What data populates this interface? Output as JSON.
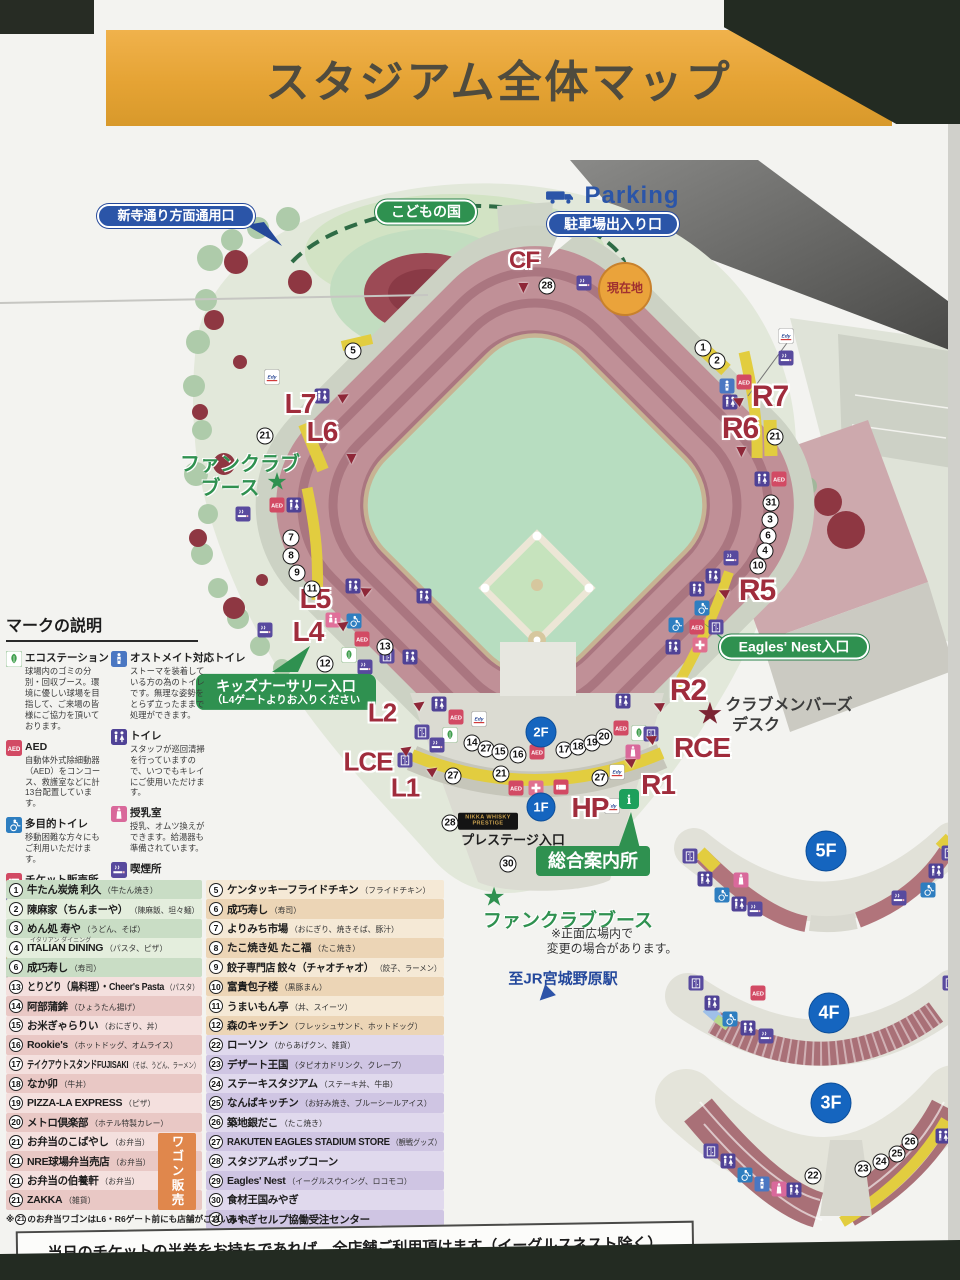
{
  "banner": {
    "title": "スタジアム全体マップ"
  },
  "bottom_note": "当日のチケットの半券をお持ちであれば、全店舗ご利用頂けます（イーグルスネスト除く）",
  "map": {
    "pills": [
      {
        "name": "shintera-gate-pill",
        "cls": "bluepill",
        "text": "新寺通り方面通用口",
        "x": 176,
        "y": 216,
        "w": 158,
        "fs": 13
      },
      {
        "name": "kodomonokuni-pill",
        "cls": "greenpill",
        "text": "こどもの国",
        "x": 426,
        "y": 212,
        "w": 102,
        "fs": 14
      },
      {
        "name": "parking-gate-pill",
        "cls": "bluepill",
        "text": "駐車場出入り口",
        "x": 613,
        "y": 224,
        "w": 132,
        "fs": 14
      },
      {
        "name": "kids-nursery-entrance-pill",
        "cls": "greenbox kidsbox",
        "lines": [
          "キッズナーサリー入口",
          "（L4ゲートよりお入りください"
        ],
        "x": 286,
        "y": 692,
        "w": 180
      },
      {
        "name": "eagles-nest-entrance-pill",
        "cls": "greenpill",
        "text": "Eagles' Nest入口",
        "x": 794,
        "y": 647,
        "w": 150,
        "fs": 14
      },
      {
        "name": "information-center-box",
        "cls": "greenbox sougou",
        "text": "総合案内所",
        "x": 593,
        "y": 861,
        "w": 114,
        "fs": 18
      },
      {
        "name": "current-location-badge",
        "cls": "genchi",
        "text": "現在地",
        "x": 625,
        "y": 289
      },
      {
        "name": "nikka-whisky-prestige-sign",
        "cls": "nikka",
        "lines": [
          "NIKKA WHISKY",
          "PRESTIGE"
        ],
        "x": 488,
        "y": 821,
        "w": 60
      }
    ],
    "texts": [
      {
        "name": "parking-label",
        "t": "Parking",
        "x": 632,
        "y": 196,
        "cls": "parking",
        "fs": 24
      },
      {
        "name": "fanclub-booth-left-line1",
        "t": "ファンクラブ",
        "x": 240,
        "y": 462,
        "cls": "gtext",
        "fs": 20
      },
      {
        "name": "fanclub-booth-left-line2",
        "t": "ブース",
        "x": 230,
        "y": 486,
        "cls": "gtext",
        "fs": 20
      },
      {
        "name": "fanclub-star-left",
        "t": "★",
        "x": 277,
        "y": 482,
        "cls": "star-green",
        "fs": 24
      },
      {
        "name": "fanclub-booth-front",
        "t": "ファンクラブブース",
        "x": 568,
        "y": 919,
        "cls": "gtext",
        "fs": 19
      },
      {
        "name": "fanclub-star-front",
        "t": "★",
        "x": 494,
        "y": 897,
        "cls": "star-green",
        "fs": 26
      },
      {
        "name": "front-plaza-note-line1",
        "t": "※正面広場内で",
        "x": 592,
        "y": 933,
        "cls": "note",
        "fs": 12
      },
      {
        "name": "front-plaza-note-line2",
        "t": "変更の場合があります。",
        "x": 612,
        "y": 948,
        "cls": "note",
        "fs": 12
      },
      {
        "name": "jr-station-label",
        "t": "至JR宮城野原駅",
        "x": 563,
        "y": 978,
        "cls": "jrtext",
        "fs": 15
      },
      {
        "name": "jr-station-arrow",
        "t": "▶",
        "x": 546,
        "y": 996,
        "cls": "jrarrow",
        "fs": 20,
        "rot": 135
      },
      {
        "name": "club-members-desk-line1",
        "t": "クラブメンバーズ",
        "x": 789,
        "y": 703,
        "cls": "dtext",
        "fs": 16
      },
      {
        "name": "club-members-desk-line2",
        "t": "デスク",
        "x": 756,
        "y": 723,
        "cls": "dtext",
        "fs": 16
      },
      {
        "name": "club-members-star",
        "t": "★",
        "x": 710,
        "y": 714,
        "cls": "star-red",
        "fs": 30
      },
      {
        "name": "prestige-entrance-label",
        "t": "プレステージ入口",
        "x": 513,
        "y": 839,
        "cls": "ptext",
        "fs": 13
      }
    ],
    "gates": [
      [
        "CF",
        524,
        261,
        24,
        [
          524,
          288,
          90
        ]
      ],
      [
        "L7",
        300,
        404,
        28,
        [
          344,
          396,
          -30
        ]
      ],
      [
        "L6",
        322,
        432,
        28,
        [
          352,
          459,
          90
        ]
      ],
      [
        "L5",
        315,
        599,
        28,
        [
          367,
          590,
          -25
        ]
      ],
      [
        "L4",
        308,
        632,
        28,
        [
          344,
          624,
          -35
        ]
      ],
      [
        "L2",
        382,
        713,
        26,
        [
          420,
          704,
          -35
        ]
      ],
      [
        "LCE",
        368,
        762,
        26,
        [
          407,
          749,
          -35
        ]
      ],
      [
        "L1",
        405,
        788,
        26,
        [
          433,
          770,
          -35
        ]
      ],
      [
        "HP",
        590,
        808,
        28,
        null
      ],
      [
        "R7",
        770,
        397,
        30,
        [
          737,
          401,
          205
        ]
      ],
      [
        "R6",
        740,
        429,
        30,
        [
          742,
          452,
          90
        ]
      ],
      [
        "R5",
        757,
        591,
        30,
        [
          723,
          593,
          205
        ]
      ],
      [
        "R2",
        688,
        691,
        30,
        [
          658,
          706,
          205
        ]
      ],
      [
        "RCE",
        702,
        748,
        28,
        [
          650,
          739,
          205
        ]
      ],
      [
        "R1",
        658,
        785,
        28,
        [
          629,
          762,
          205
        ]
      ]
    ],
    "floor_badges": [
      [
        "2F",
        541,
        732,
        31
      ],
      [
        "1F",
        541,
        807,
        29
      ],
      [
        "5F",
        826,
        851,
        41
      ],
      [
        "4F",
        829,
        1013,
        41
      ],
      [
        "3F",
        831,
        1103,
        41
      ]
    ],
    "numbers": [
      [
        5,
        353,
        351
      ],
      [
        21,
        265,
        436
      ],
      [
        7,
        291,
        538
      ],
      [
        8,
        291,
        556
      ],
      [
        9,
        297,
        573
      ],
      [
        11,
        312,
        589
      ],
      [
        12,
        325,
        664
      ],
      [
        13,
        385,
        647
      ],
      [
        14,
        472,
        743
      ],
      [
        27,
        486,
        749
      ],
      [
        15,
        500,
        752
      ],
      [
        16,
        518,
        755
      ],
      [
        17,
        564,
        750
      ],
      [
        18,
        578,
        747
      ],
      [
        19,
        592,
        743
      ],
      [
        20,
        604,
        737
      ],
      [
        27,
        453,
        776
      ],
      [
        21,
        501,
        774
      ],
      [
        27,
        600,
        778
      ],
      [
        28,
        547,
        286
      ],
      [
        28,
        450,
        823
      ],
      [
        30,
        508,
        864
      ],
      [
        1,
        703,
        348
      ],
      [
        2,
        717,
        361
      ],
      [
        21,
        775,
        437
      ],
      [
        31,
        771,
        503
      ],
      [
        3,
        770,
        520
      ],
      [
        6,
        768,
        536
      ],
      [
        4,
        765,
        551
      ],
      [
        10,
        758,
        566
      ],
      [
        22,
        813,
        1176
      ],
      [
        23,
        863,
        1169
      ],
      [
        24,
        881,
        1162
      ],
      [
        25,
        897,
        1154
      ],
      [
        26,
        910,
        1142
      ]
    ],
    "icons": [
      [
        "edy",
        272,
        377
      ],
      [
        "toilet",
        322,
        396
      ],
      [
        "aed",
        277,
        505
      ],
      [
        "toilet",
        294,
        505
      ],
      [
        "smoke",
        243,
        514
      ],
      [
        "smoke",
        265,
        630
      ],
      [
        "kids",
        333,
        620
      ],
      [
        "wheel",
        354,
        621
      ],
      [
        "aed",
        362,
        639
      ],
      [
        "eco",
        349,
        655
      ],
      [
        "elev",
        387,
        656
      ],
      [
        "toilet",
        410,
        657
      ],
      [
        "smoke",
        365,
        667
      ],
      [
        "toilet",
        353,
        586
      ],
      [
        "toilet",
        424,
        596
      ],
      [
        "toilet",
        439,
        704
      ],
      [
        "aed",
        456,
        717
      ],
      [
        "edy",
        479,
        719
      ],
      [
        "eco",
        450,
        735
      ],
      [
        "elev",
        422,
        732
      ],
      [
        "smoke",
        437,
        745
      ],
      [
        "elev",
        405,
        760
      ],
      [
        "aed",
        537,
        752
      ],
      [
        "aed",
        516,
        788
      ],
      [
        "firstaid",
        536,
        788
      ],
      [
        "ticket",
        561,
        787
      ],
      [
        "edy",
        617,
        772
      ],
      [
        "toilet",
        623,
        701
      ],
      [
        "aed",
        621,
        728
      ],
      [
        "eco",
        639,
        733
      ],
      [
        "nursing",
        633,
        752
      ],
      [
        "elev",
        651,
        734
      ],
      [
        "edy",
        612,
        806
      ],
      [
        "info",
        629,
        799,
        20
      ],
      [
        "ostomate",
        727,
        386
      ],
      [
        "aed",
        744,
        382
      ],
      [
        "toilet",
        730,
        402
      ],
      [
        "toilet",
        762,
        479
      ],
      [
        "aed",
        779,
        479
      ],
      [
        "edy",
        786,
        336
      ],
      [
        "smoke",
        786,
        358
      ],
      [
        "smoke",
        584,
        283
      ],
      [
        "toilet",
        617,
        301
      ],
      [
        "smoke",
        731,
        558
      ],
      [
        "toilet",
        713,
        576
      ],
      [
        "toilet",
        697,
        589
      ],
      [
        "wheel",
        702,
        608
      ],
      [
        "wheel",
        676,
        625
      ],
      [
        "aed",
        697,
        627
      ],
      [
        "elev",
        716,
        627
      ],
      [
        "toilet",
        673,
        647
      ],
      [
        "firstaid",
        700,
        645
      ],
      [
        "elev",
        690,
        856
      ],
      [
        "toilet",
        705,
        879
      ],
      [
        "wheel",
        722,
        895
      ],
      [
        "toilet",
        739,
        904
      ],
      [
        "smoke",
        755,
        909
      ],
      [
        "nursing",
        741,
        880
      ],
      [
        "toilet",
        936,
        871
      ],
      [
        "wheel",
        928,
        890
      ],
      [
        "smoke",
        899,
        898
      ],
      [
        "elev",
        949,
        853
      ],
      [
        "elev",
        696,
        983
      ],
      [
        "toilet",
        712,
        1003
      ],
      [
        "wheel",
        730,
        1019
      ],
      [
        "toilet",
        748,
        1028
      ],
      [
        "smoke",
        766,
        1036
      ],
      [
        "aed",
        758,
        993
      ],
      [
        "elev",
        950,
        983
      ],
      [
        "elev",
        711,
        1151
      ],
      [
        "toilet",
        728,
        1161
      ],
      [
        "wheel",
        745,
        1175
      ],
      [
        "ostomate",
        762,
        1184
      ],
      [
        "nursing",
        779,
        1189
      ],
      [
        "toilet",
        794,
        1190
      ],
      [
        "toilet",
        943,
        1136
      ],
      [
        "truck",
        560,
        196,
        30
      ]
    ]
  },
  "legend": {
    "title": "マークの説明",
    "columns": [
      [
        {
          "icon": "eco",
          "name": "エコステーション",
          "desc": "球場内のゴミの分別・回収ブース。環境に優しい球場を目指して、ご来場の皆様にご協力を頂いております。"
        },
        {
          "icon": "aed",
          "name": "AED",
          "desc": "自動体外式除細動器（AED）をコンコース、救護室などに計13台配置しています。"
        },
        {
          "icon": "wheel",
          "name": "多目的トイレ",
          "desc": "移動困難な方々にもご利用いただけます。"
        },
        {
          "icon": "ticket",
          "name": "チケット販売所",
          "desc": ""
        },
        {
          "icon": "elev",
          "name": "エレベーター",
          "desc": ""
        },
        {
          "icon": "firstaid",
          "name": "救護室",
          "desc": ""
        }
      ],
      [
        {
          "icon": "ostomate",
          "name": "オストメイト対応トイレ",
          "desc": "ストーマを装着している方の為のトイレです。無理な姿勢をとらず立ったままで処理ができます。"
        },
        {
          "icon": "toilet",
          "name": "トイレ",
          "desc": "スタッフが巡回清掃を行っていますので、いつでもキレイにご使用いただけます。"
        },
        {
          "icon": "nursing",
          "name": "授乳室",
          "desc": "授乳、オムツ換えができます。給湯器も準備されています。"
        },
        {
          "icon": "smoke",
          "name": "喫煙所",
          "desc": ""
        },
        {
          "icon": "kids",
          "name": "託児所",
          "desc": ""
        },
        {
          "icon": "edy",
          "name": "Edyチャージ",
          "desc": ""
        }
      ]
    ],
    "payment": {
      "id_label": "iD",
      "edy_label": "Edy",
      "credit_label": "CREDIT",
      "note1": "iD、Edy、クレジットカードのご利用は全店で",
      "note2": "可能です。（一部ワゴン販売店舗はのぞく）"
    }
  },
  "shops": {
    "left": [
      {
        "n": "1",
        "name": "牛たん炭焼 利久",
        "sub": "牛たん焼き",
        "shade": "g1"
      },
      {
        "n": "2",
        "name": "陳麻家（ちんまーや）",
        "sub": "陳麻飯、坦々麺",
        "shade": "g2"
      },
      {
        "n": "3",
        "name": "めん処 寿や",
        "sub": "うどん、そば",
        "shade": "g1"
      },
      {
        "n": "4",
        "name": "ITALIAN DINING",
        "sub": "パスタ、ピザ",
        "ruby": "イタリアン ダイニング",
        "shade": "g2"
      },
      {
        "n": "6",
        "name": "成巧寿し",
        "sub": "寿司",
        "shade": "g1"
      },
      {
        "n": "13",
        "name": "とりどり（鳥料理）・Cheer's Pasta",
        "sub": "パスタ",
        "shade": "p1"
      },
      {
        "n": "14",
        "name": "阿部蒲鉾",
        "sub": "ひょうたん揚げ",
        "shade": "p2"
      },
      {
        "n": "15",
        "name": "お米ぎゃらりい",
        "sub": "おにぎり、丼",
        "shade": "p1"
      },
      {
        "n": "16",
        "name": "Rookie's",
        "sub": "ホットドッグ、オムライス",
        "shade": "p2"
      },
      {
        "n": "17",
        "name": "テイクアウトスタンドFUJISAKI",
        "sub": "そば、うどん、ラーメン",
        "shade": "p1"
      },
      {
        "n": "18",
        "name": "なか卯",
        "sub": "牛丼",
        "shade": "p2"
      },
      {
        "n": "19",
        "name": "PIZZA-LA EXPRESS",
        "sub": "ピザ",
        "shade": "p1"
      },
      {
        "n": "20",
        "name": "メトロ倶楽部",
        "sub": "ホテル特製カレー",
        "shade": "p2"
      },
      {
        "n": "21",
        "name": "お弁当のこばやし",
        "sub": "お弁当",
        "shade": "p1"
      },
      {
        "n": "21",
        "name": "NRE球場弁当売店",
        "sub": "お弁当",
        "shade": "p2"
      },
      {
        "n": "21",
        "name": "お弁当の伯養軒",
        "sub": "お弁当",
        "shade": "p1"
      },
      {
        "n": "21",
        "name": "ZAKKA",
        "sub": "雑貨",
        "shade": "p2"
      }
    ],
    "right": [
      {
        "n": "5",
        "name": "ケンタッキーフライドチキン",
        "sub": "フライドチキン",
        "shade": "t1"
      },
      {
        "n": "6",
        "name": "成巧寿し",
        "sub": "寿司",
        "shade": "t2"
      },
      {
        "n": "7",
        "name": "よりみち市場",
        "sub": "おにぎり、焼きそば、豚汁",
        "shade": "t1"
      },
      {
        "n": "8",
        "name": "たこ焼き処 たこ福",
        "sub": "たこ焼き",
        "shade": "t2"
      },
      {
        "n": "9",
        "name": "餃子専門店 餃々（チャオチャオ）",
        "sub": "餃子、ラーメン",
        "shade": "t1"
      },
      {
        "n": "10",
        "name": "富貴包子楼",
        "sub": "黒豚まん",
        "shade": "t2"
      },
      {
        "n": "11",
        "name": "うまいもん亭",
        "sub": "丼、スイーツ",
        "shade": "t1"
      },
      {
        "n": "12",
        "name": "森のキッチン",
        "sub": "フレッシュサンド、ホットドッグ",
        "shade": "t2"
      },
      {
        "n": "22",
        "name": "ローソン",
        "sub": "からあげクン、雑貨",
        "shade": "b1"
      },
      {
        "n": "23",
        "name": "デザート王国",
        "sub": "タピオカドリンク、クレープ",
        "shade": "b2"
      },
      {
        "n": "24",
        "name": "ステーキスタジアム",
        "sub": "ステーキ丼、牛串",
        "shade": "b1"
      },
      {
        "n": "25",
        "name": "なんばキッチン",
        "sub": "お好み焼き、ブルーシールアイス",
        "shade": "b2"
      },
      {
        "n": "26",
        "name": "築地銀だこ",
        "sub": "たこ焼き",
        "shade": "b1"
      },
      {
        "n": "27",
        "name": "RAKUTEN EAGLES STADIUM STORE",
        "sub": "観戦グッズ",
        "shade": "b2"
      },
      {
        "n": "28",
        "name": "スタジアムポップコーン",
        "sub": "",
        "shade": "b1"
      },
      {
        "n": "29",
        "name": "Eagles' Nest",
        "sub": "イーグルスウイング、ロコモコ",
        "shade": "b2"
      },
      {
        "n": "30",
        "name": "食材王国みやぎ",
        "sub": "",
        "shade": "b1"
      },
      {
        "n": "31",
        "name": "みやぎセルプ協働受注センター",
        "sub": "",
        "shade": "b2"
      }
    ],
    "wagon_label": "ワゴン販売",
    "footnote_pre": "※",
    "footnote_num": "21",
    "footnote_post": "のお弁当ワゴンはL6・R6ゲート前にも店舗がございます。"
  }
}
